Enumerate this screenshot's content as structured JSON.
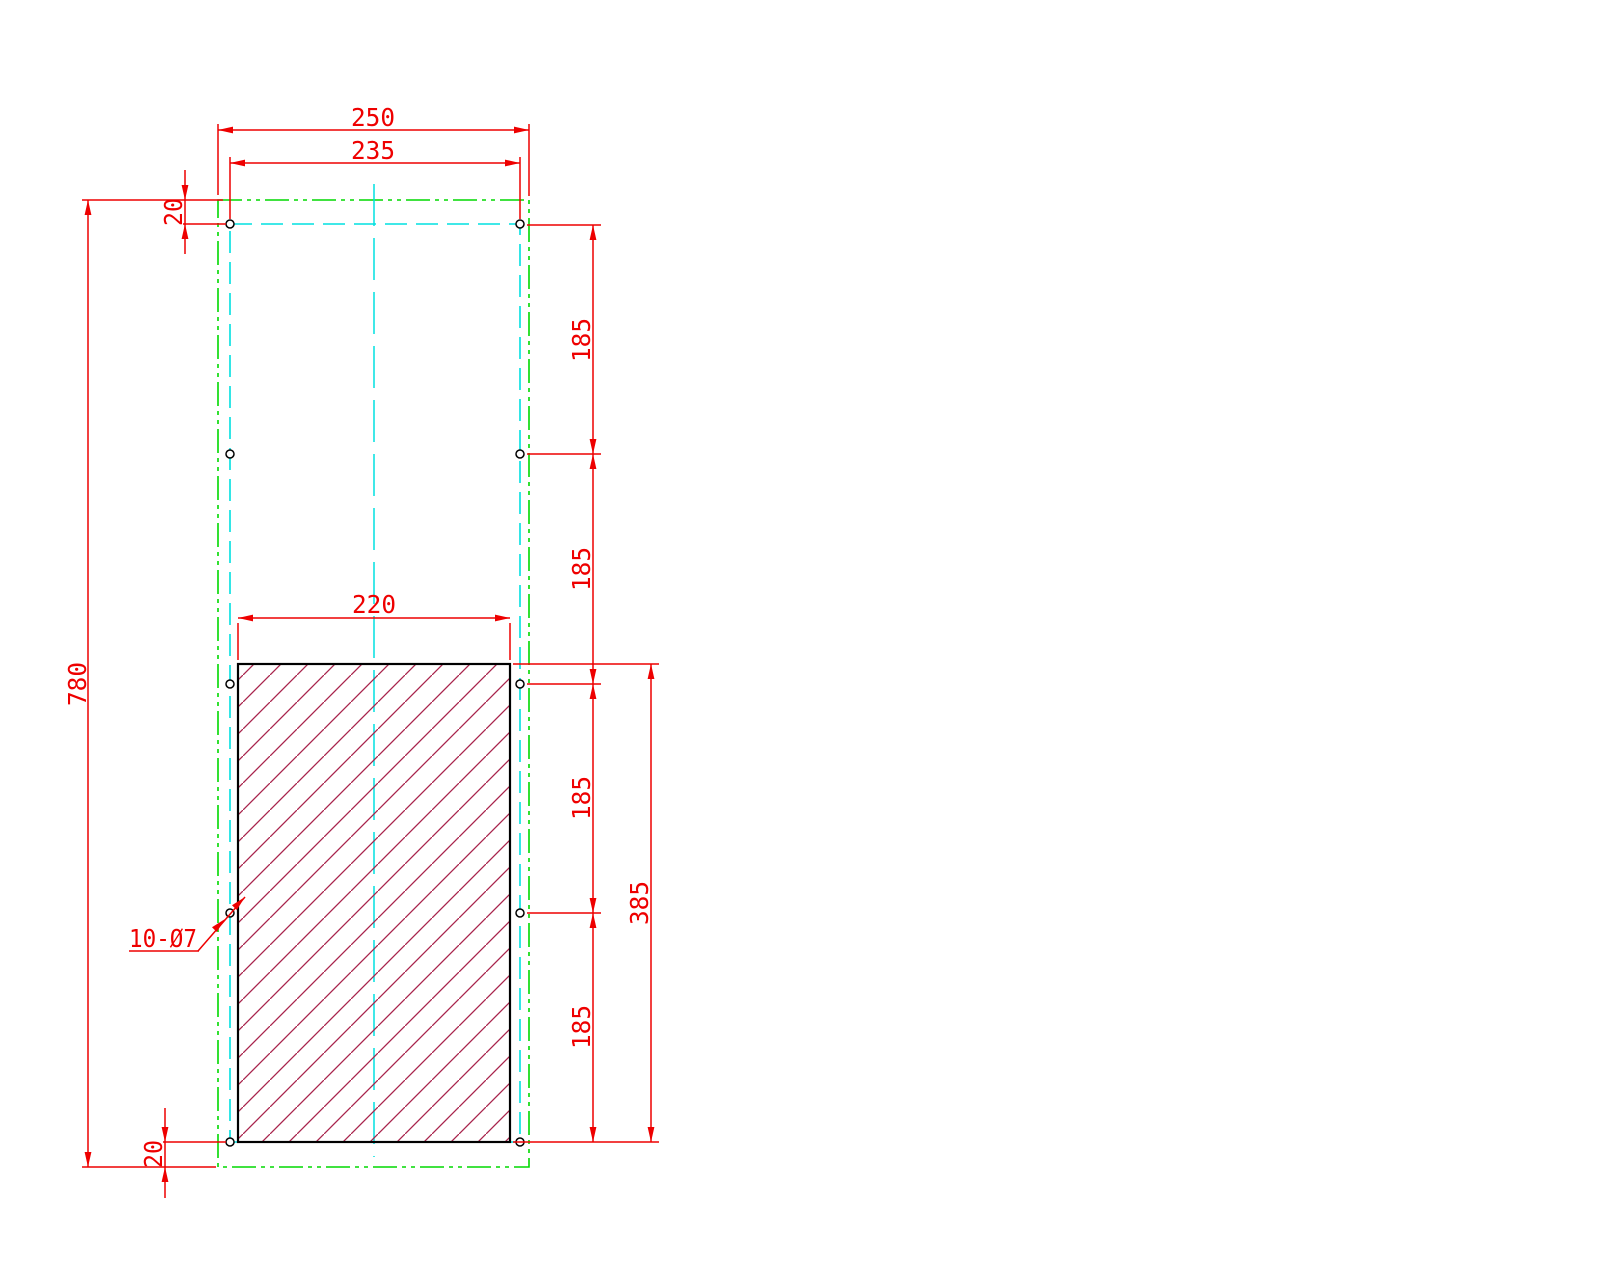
{
  "drawing": {
    "description": "panel drilling and cutout drawing",
    "hole_count_note": "10 holes diameter 7"
  },
  "dimensions": {
    "top_width_outer": "250",
    "top_width_holes": "235",
    "top_margin": "20",
    "overall_height": "780",
    "bottom_margin": "20",
    "cutout_width": "220",
    "hole_pitches": [
      "185",
      "185",
      "185",
      "185"
    ],
    "cutout_height": "385",
    "hole_callout": "10-Ø7"
  },
  "colors": {
    "red": "#ee0000",
    "green": "#00d800",
    "cyan": "#00e0e0",
    "hatch": "#a8244c",
    "edge": "#000000",
    "background": "#ffffff"
  }
}
